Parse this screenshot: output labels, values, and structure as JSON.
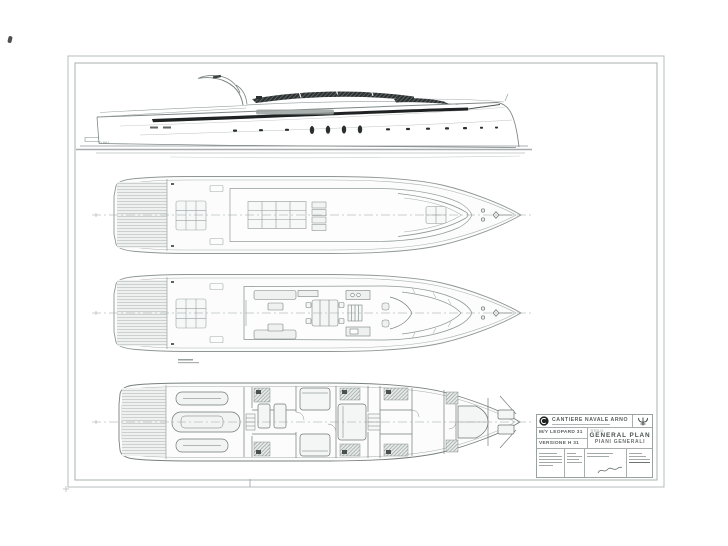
{
  "colors": {
    "paper": "#ffffff",
    "line_light": "#aab1b0",
    "line_mid": "#8d9594",
    "line_dark": "#565e5d",
    "ink_black": "#1e2222",
    "glass_dark": "#2c3031"
  },
  "drawing": {
    "views": [
      "side-profile-view",
      "upper-deck-plan",
      "main-deck-plan",
      "lower-deck-plan"
    ],
    "centerline_style": "dash-dot"
  },
  "labels": {
    "waterline": "D.W.L."
  },
  "title_block": {
    "logo_icon": "shipyard-roundel-icon",
    "brand_icon": "trident-icon",
    "company": "CANTIERE NAVALE ARNO",
    "model": "M/Y LEOPARD 31",
    "version": "VERSIONE H 31",
    "title_label": "TITOLO:",
    "drawing_title": "GENERAL PLAN",
    "drawing_subtitle": "PIANI GENERALI"
  }
}
